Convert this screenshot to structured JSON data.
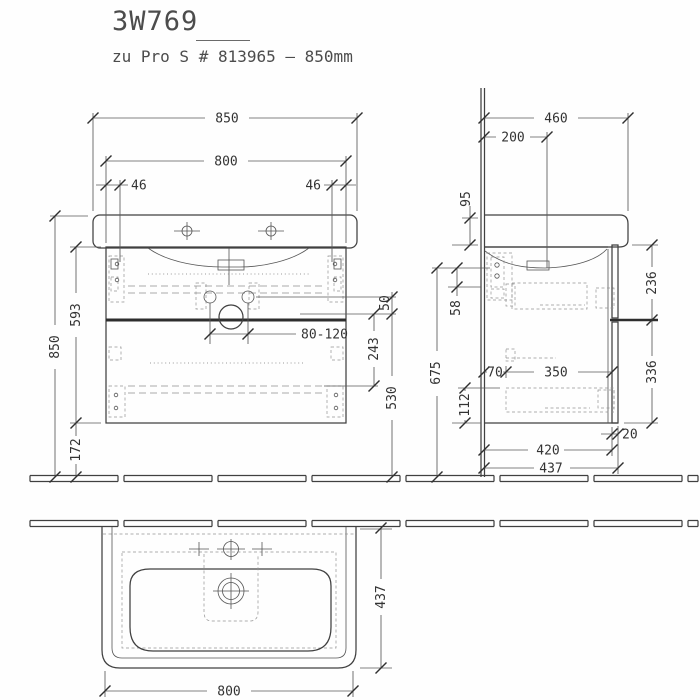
{
  "drawing": {
    "title": "3W769",
    "subtitle": "zu Pro S # 813965 – 850mm",
    "front": {
      "basin_width": "850",
      "cabinet_width": "800",
      "fixing_offset_left": "46",
      "fixing_offset_right": "46",
      "total_height": "850",
      "cabinet_height": "593",
      "bottom_clearance": "172",
      "drain_range": "80-120",
      "trap_offset": "50",
      "drawer_span": "243",
      "divider_height": "530"
    },
    "side": {
      "basin_depth": "460",
      "tap_setback": "200",
      "apron_height": "95",
      "bracket_span": "58",
      "mount_height": "675",
      "rail_setback": "70",
      "rail_length": "350",
      "lower_clearance": "112",
      "upper_front_height": "236",
      "lower_front_height": "336",
      "front_thickness": "20",
      "carcass_depth": "420",
      "overall_depth": "437"
    },
    "plan": {
      "basin_depth": "437",
      "cabinet_width": "800"
    }
  }
}
